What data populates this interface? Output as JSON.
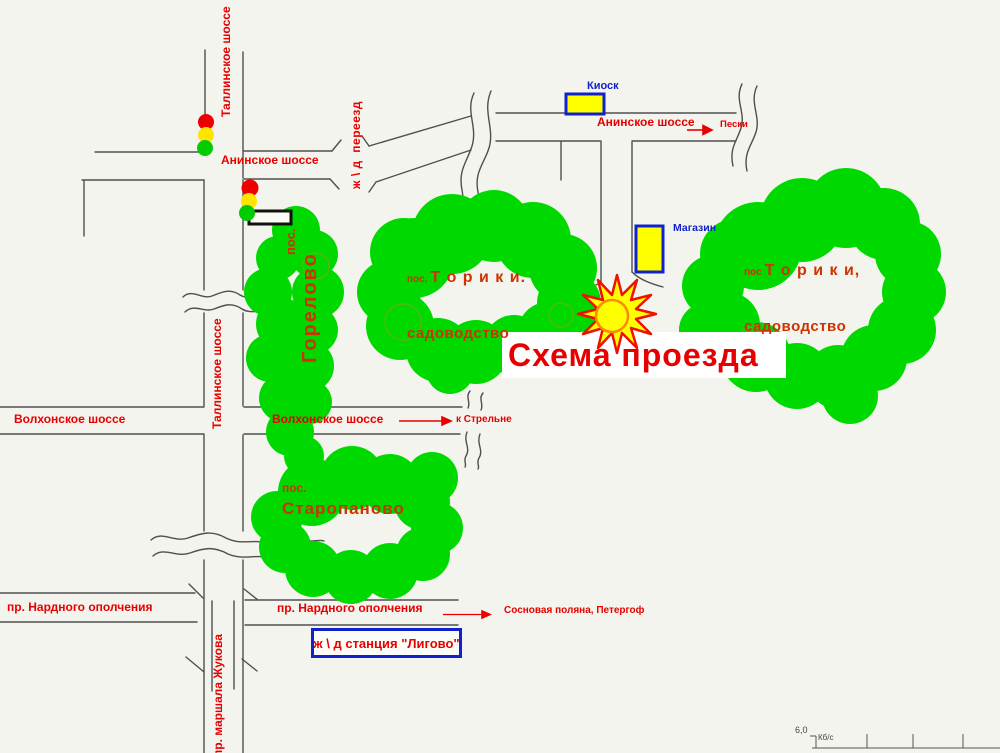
{
  "title": "Схема проезда",
  "roads": {
    "tallinskoe_top": "Таллинское шоссе",
    "tallinskoe_mid": "Таллинское шоссе",
    "aninskoe_west": "Анинское шоссе",
    "aninskoe_east": "Анинское шоссе",
    "rail_crossing": "ж \\ д  переезд",
    "volkhonskoe_west": "Волхонское шоссе",
    "volkhonskoe_mid": "Волхонское шоссе",
    "narodnogo_west": "пр. Нардного ополчения",
    "narodnogo_east": "пр. Нардного ополчения",
    "zhukova": "пр. маршала Жукова"
  },
  "destinations": {
    "peski": "Пески",
    "to_strelna": "к Стрельне",
    "sosnovaya": "Сосновая поляна, Петергоф"
  },
  "landmarks": {
    "kiosk": "Киоск",
    "shop": "Магазин",
    "ligovo_station": "ж \\ д станция \"Лигово\""
  },
  "settlements": {
    "gorelovo": {
      "prefix": "пос.",
      "name": "Горелово"
    },
    "toriki_mid": {
      "prefix": "пос.",
      "name": "Т о р и к и.",
      "subtitle": "садоводство"
    },
    "toriki_right": {
      "prefix": "пос",
      "name": "Т о р и к и,",
      "subtitle": "садоводство"
    },
    "staropanovo": {
      "prefix": "пос.",
      "name": "Старопаново"
    }
  },
  "status_bar": {
    "speed_value": "6,0",
    "speed_unit": "Кб/с"
  },
  "colors": {
    "cloud_green": "#00d900",
    "label_red": "#e80000",
    "cloud_text": "#cc3300",
    "landmark_blue": "#1122cc",
    "highlight_yellow": "#ffff00",
    "star_red": "#ee1100",
    "sun_orange": "#ff8800",
    "road_gray": "#4f4f4f"
  }
}
